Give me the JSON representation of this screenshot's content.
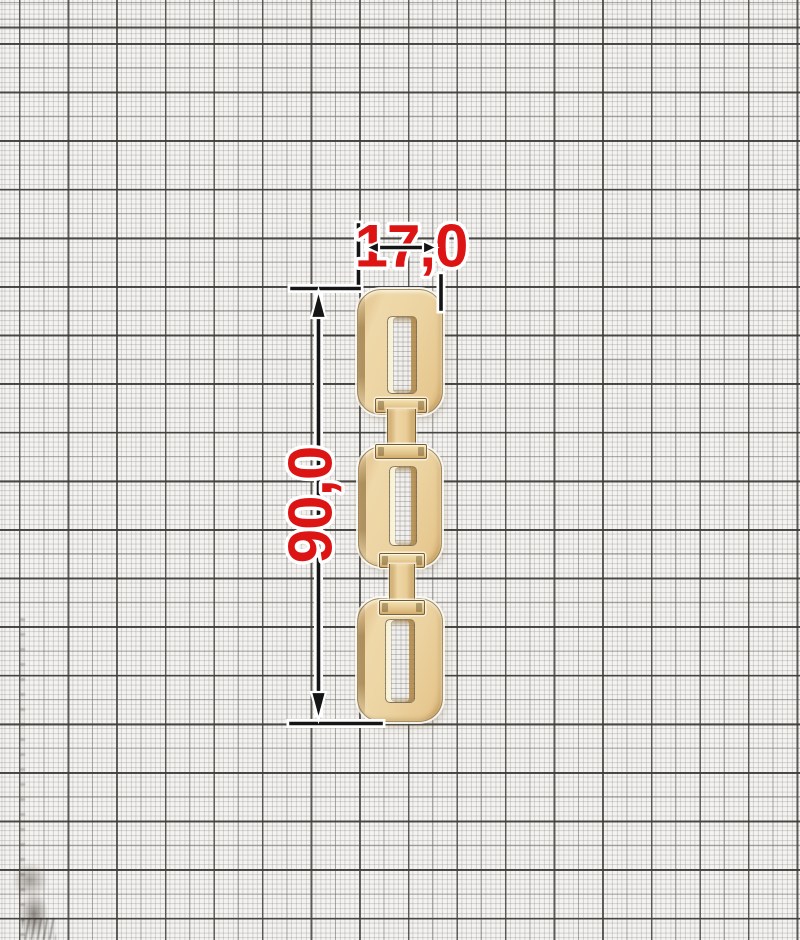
{
  "document": {
    "kind": "dimensioned product scan",
    "subject": "flat rectangular-link chain, three links with two I-shaped connectors, on millimeter graph paper"
  },
  "dimensions": {
    "width_label": "17,0",
    "length_label": "90,0"
  },
  "annotation_style": {
    "label_color": "#dc1414",
    "line_color": "#151515",
    "halo_color": "#ffffff"
  },
  "chain": {
    "link_count": 3,
    "connector_count": 2,
    "colors": {
      "gold_face": "#ecd3a1",
      "gold_highlight": "#f6ecca",
      "gold_edge": "#b08448",
      "outline": "#6b5226"
    }
  },
  "paper": {
    "background": "#f4f3f1",
    "fine_line": "#8e8a84",
    "medium_line": "#706d68",
    "bold_line": "#3a3834"
  }
}
